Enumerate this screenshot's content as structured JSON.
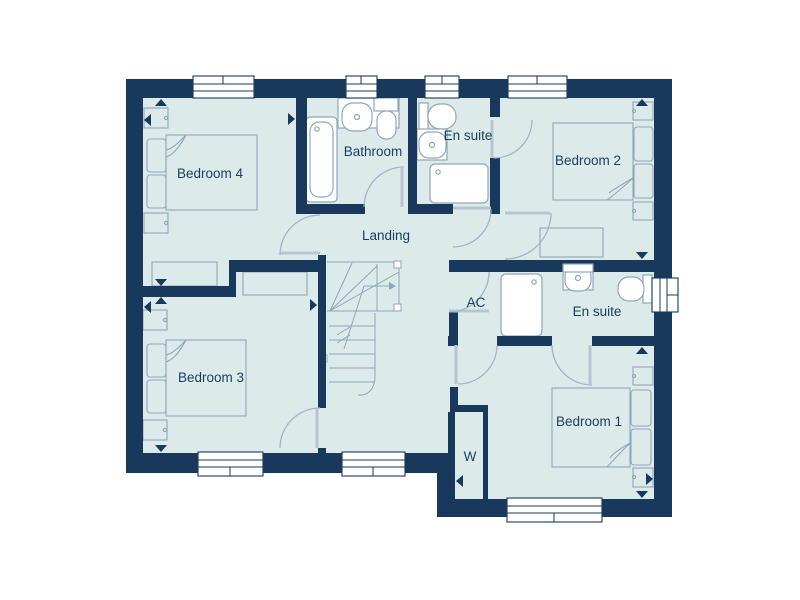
{
  "floor_plan": {
    "title": "first-floor-plan",
    "rooms": [
      {
        "id": "bedroom4",
        "label": "Bedroom 4"
      },
      {
        "id": "bathroom",
        "label": "Bathroom"
      },
      {
        "id": "ensuite_top",
        "label": "En suite"
      },
      {
        "id": "bedroom2",
        "label": "Bedroom 2"
      },
      {
        "id": "landing",
        "label": "Landing"
      },
      {
        "id": "ac",
        "label": "AC"
      },
      {
        "id": "ensuite_right",
        "label": "En suite"
      },
      {
        "id": "bedroom3",
        "label": "Bedroom 3"
      },
      {
        "id": "bedroom1",
        "label": "Bedroom 1"
      },
      {
        "id": "wardrobe",
        "label": "W"
      }
    ],
    "colors": {
      "wall": "#18395c",
      "floor": "#dceae9",
      "fixture_outline": "#8fa7ba",
      "door_swing": "#9fb5c6",
      "label_text": "#1d3c5f",
      "background": "#ffffff"
    }
  }
}
